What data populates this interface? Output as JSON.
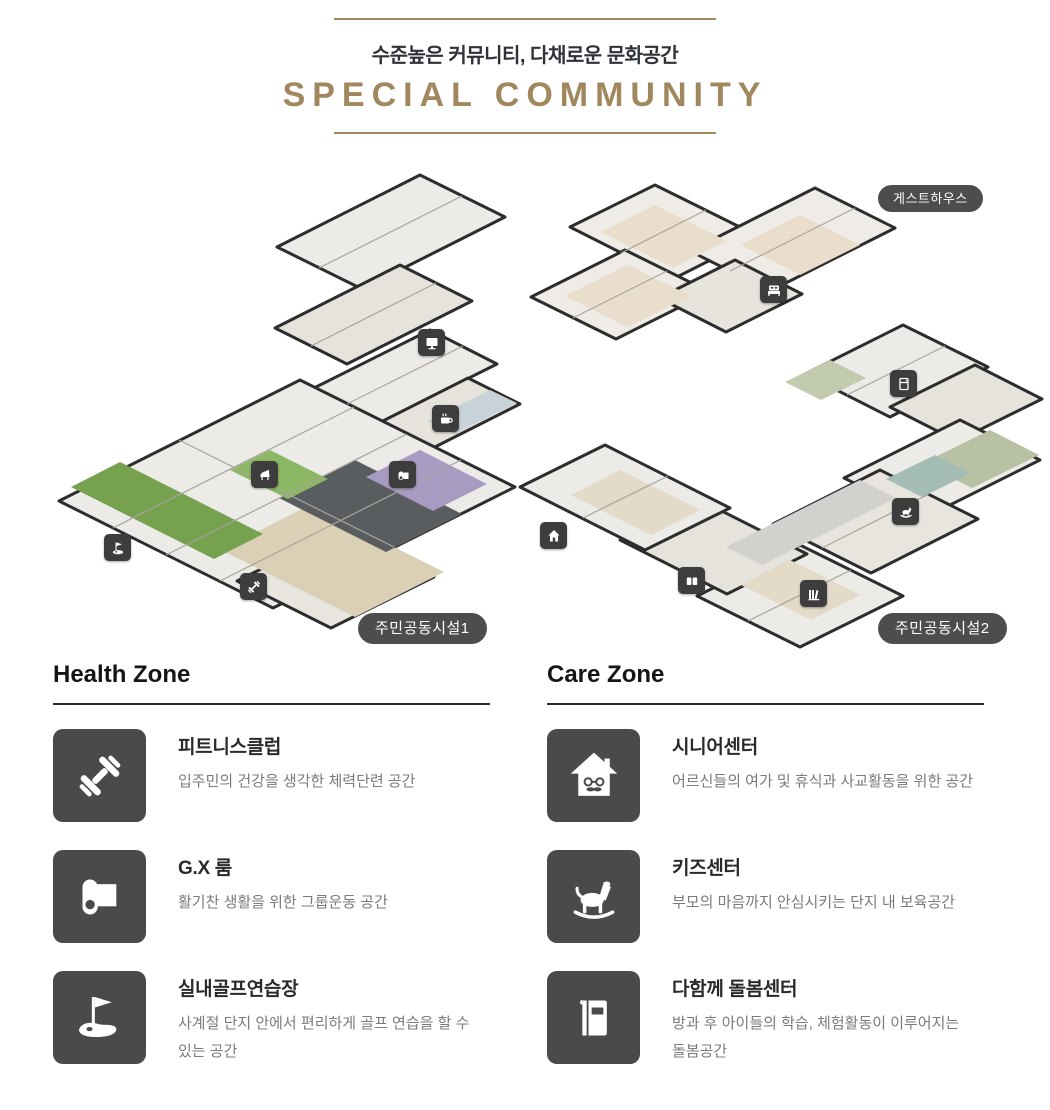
{
  "header": {
    "subtitle": "수준높은 커뮤니티, 다채로운 문화공간",
    "title": "SPECIAL COMMUNITY"
  },
  "plans": {
    "guesthouse_label": "게스트하우스",
    "plan1_label": "주민공동시설1",
    "plan2_label": "주민공동시설2",
    "plan1_marker_icons": [
      "monitor-icon",
      "coffee-icon",
      "piano-icon",
      "yoga-mat-icon",
      "golf-flag-icon",
      "dumbbell-icon"
    ],
    "plan2_marker_icons": [
      "bed-icon",
      "fridge-icon",
      "rocking-horse-icon",
      "house-icon",
      "open-book-icon",
      "bookshelf-icon"
    ]
  },
  "zones": [
    {
      "title": "Health Zone",
      "items": [
        {
          "icon": "dumbbell-icon",
          "name": "피트니스클럽",
          "desc": "입주민의 건강을 생각한 체력단련 공간"
        },
        {
          "icon": "yoga-mat-icon",
          "name": "G.X 룸",
          "desc": "활기찬 생활을 위한 그룹운동 공간"
        },
        {
          "icon": "golf-icon",
          "name": "실내골프연습장",
          "desc": "사계절 단지 안에서 편리하게 골프 연습을 할 수 있는 공간"
        }
      ]
    },
    {
      "title": "Care Zone",
      "items": [
        {
          "icon": "senior-house-icon",
          "name": "시니어센터",
          "desc": "어르신들의 여가 및 휴식과 사교활동을 위한 공간"
        },
        {
          "icon": "rocking-horse-icon",
          "name": "키즈센터",
          "desc": "부모의 마음까지 안심시키는 단지 내 보육공간"
        },
        {
          "icon": "book-icon",
          "name": "다함께 돌봄센터",
          "desc": "방과 후 아이들의 학습, 체험활동이 이루어지는 돌봄공간"
        }
      ]
    }
  ],
  "colors": {
    "accent": "#a1875d",
    "icon_badge_bg": "#4a4a4a",
    "pill_bg": "#4d4d4d",
    "turf_green": "#76a24f",
    "gx_mat_purple": "#a89bc2",
    "text_dark": "#2a2a2a",
    "text_gray": "#7b7b7b"
  }
}
